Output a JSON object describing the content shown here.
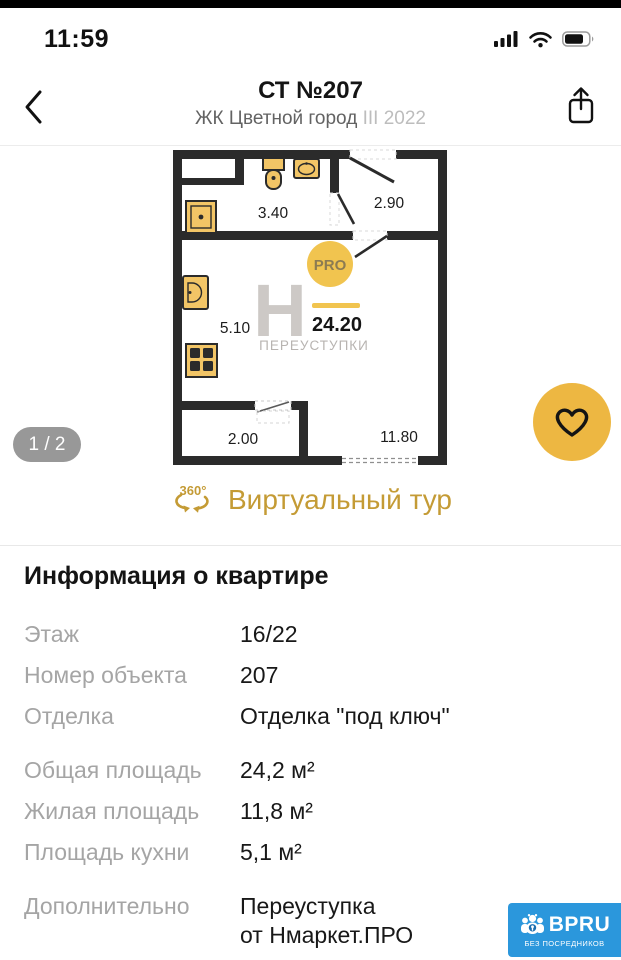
{
  "status_bar": {
    "time": "11:59"
  },
  "header": {
    "title": "СТ №207",
    "subtitle": "ЖК Цветной город",
    "subtitle_muted": "III 2022"
  },
  "gallery": {
    "page_indicator": "1 / 2",
    "virtual_tour": {
      "icon_label": "360°",
      "label": "Виртуальный тур"
    },
    "floorplan": {
      "rooms": {
        "bathroom": "3.40",
        "hall": "2.90",
        "kitchen": "5.10",
        "balcony": "2.00",
        "living": "11.80"
      },
      "total_area": "24.20",
      "watermark": {
        "letter": "Н",
        "text": "ПЕРЕУСТУПКИ",
        "badge": "PRO"
      }
    }
  },
  "info": {
    "title": "Информация о квартире",
    "rows": [
      {
        "label": "Этаж",
        "value": "16/22"
      },
      {
        "label": "Номер объекта",
        "value": "207"
      },
      {
        "label": "Отделка",
        "value": "Отделка \"под ключ\""
      },
      {
        "label": "Общая площадь",
        "value": "24,2 м²"
      },
      {
        "label": "Жилая площадь",
        "value": "11,8 м²"
      },
      {
        "label": "Площадь кухни",
        "value": "5,1 м²"
      },
      {
        "label": "Дополнительно",
        "value": "Переуступка\nот Нмаркет.ПРО"
      }
    ]
  },
  "footer_logo": {
    "name": "BPRU",
    "tagline": "БЕЗ ПОСРЕДНИКОВ"
  },
  "colors": {
    "accent_yellow": "#F1C44F",
    "heart_yellow": "#EDB742",
    "gold_text": "#C49B35",
    "logo_blue": "#2B97DC",
    "wall_dark": "#2b2b2b"
  }
}
